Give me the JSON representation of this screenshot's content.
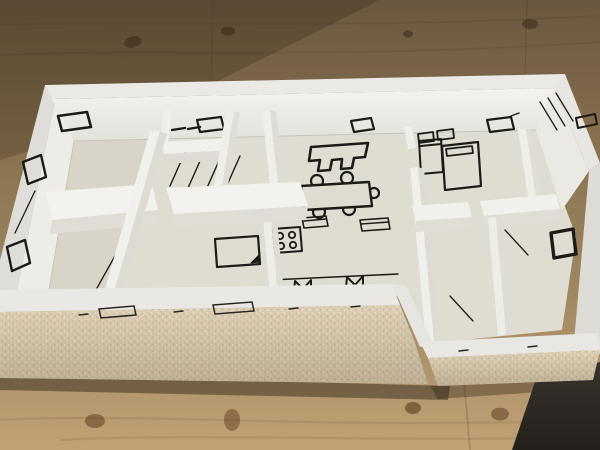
{
  "photo": {
    "subject": "architectural-scale-model",
    "scene": {
      "setting": "wooden-table-top",
      "model_type": "single-story-house-floor-plan-maquette",
      "materials": [
        "white-painted-card-walls",
        "speckled-foam-board-front-wall",
        "black-ink-floor-plan-drawings"
      ],
      "viewpoint": "high-angle-oblique"
    },
    "colors": {
      "wood_dark": "#6f5b42",
      "wood_mid": "#a38a63",
      "wood_light": "#c9a87a",
      "wall_white": "#f4f3f0",
      "wall_bright": "#fbfaf6",
      "wall_shade": "#e7e4dc",
      "floor": "#e9e5da",
      "back_wall_top": "#fdfdfa",
      "back_wall_bottom": "#ecebe3",
      "foam": "#e6d7bc",
      "foam_speck_light": "#f6eedb",
      "foam_speck_dark": "#cdbb98",
      "ink": "#1f1d1a",
      "shadow_dark": "#26221e"
    },
    "rooms": [
      "large-left-room",
      "bathroom",
      "stair-room",
      "middle-bedroom",
      "kitchen",
      "living-dining-room",
      "bedroom-top-right",
      "corner-bedroom",
      "lower-right-room",
      "storage-room"
    ],
    "furniture_markings": [
      "sofa-outline",
      "dining-table-with-six-chairs",
      "stove-four-burners",
      "kitchen-counter-line",
      "sink-rectangle",
      "island-unit",
      "bed-with-folded-corner",
      "bed-with-pillow",
      "small-bed",
      "wardrobe-rectangles",
      "window-parallelograms",
      "door-swing-lines",
      "stair-hatch-lines",
      "radiator-m-symbols",
      "tiny-handwritten-label"
    ]
  }
}
